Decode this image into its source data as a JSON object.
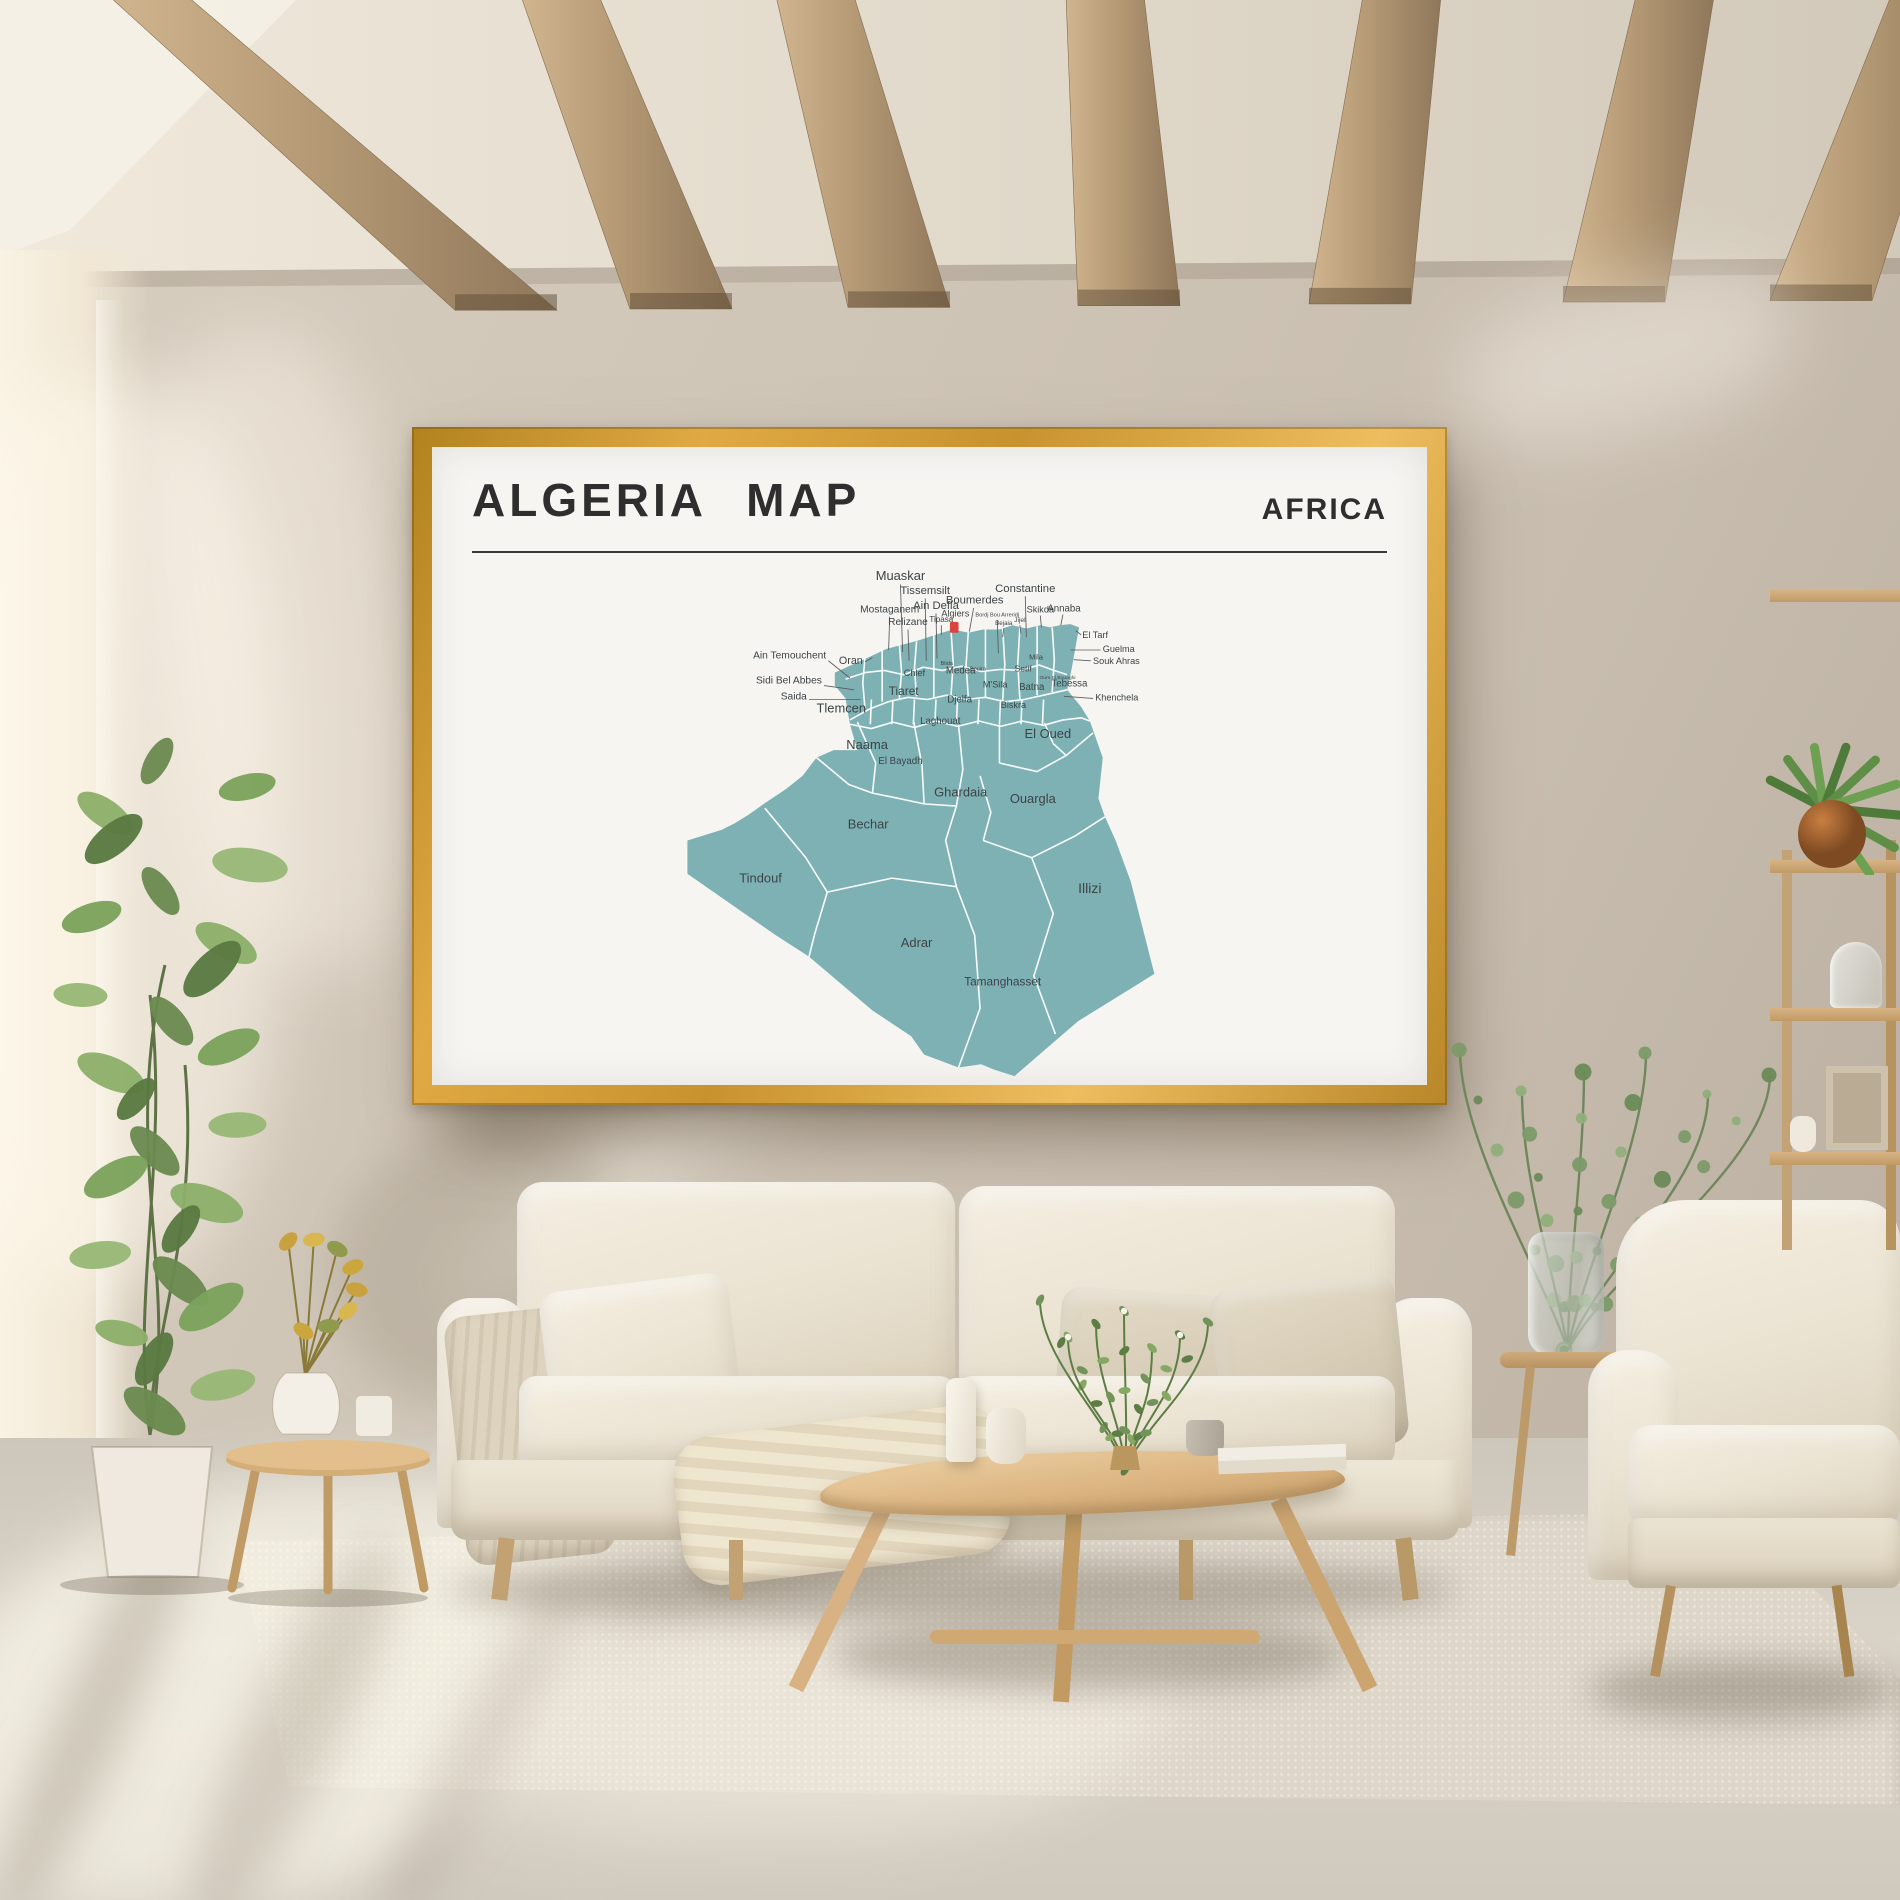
{
  "poster": {
    "title": "ALGERIA MAP",
    "region_label": "AFRICA",
    "frame_color": "#cf9a33",
    "paper_color": "#f6f5f2",
    "title_color": "#2e2e2e"
  },
  "map": {
    "country": "Algeria",
    "fill": "#7db1b4",
    "border_color": "#ffffff",
    "label_color": "#3d4446",
    "marker": {
      "label": "Algiers",
      "color": "#d9453e",
      "x": 424,
      "y": 59,
      "w": 8,
      "h": 10
    },
    "labels": [
      {
        "t": "Muaskar",
        "x": 378,
        "y": 20,
        "fs": 12,
        "a": "m"
      },
      {
        "t": "Tissemsilt",
        "x": 401,
        "y": 33,
        "fs": 10.5,
        "a": "m"
      },
      {
        "t": "Ain Defla",
        "x": 411,
        "y": 47,
        "fs": 10.5,
        "a": "m"
      },
      {
        "t": "Boumerdes",
        "x": 447,
        "y": 42,
        "fs": 10.5,
        "a": "m"
      },
      {
        "t": "Constantine",
        "x": 494,
        "y": 31,
        "fs": 10.5,
        "a": "m"
      },
      {
        "t": "Mostaganem",
        "x": 368,
        "y": 50,
        "fs": 9.5,
        "a": "m"
      },
      {
        "t": "Relizane",
        "x": 385,
        "y": 62,
        "fs": 9.5,
        "a": "m"
      },
      {
        "t": "Tipasa",
        "x": 416,
        "y": 59,
        "fs": 7.5,
        "a": "m"
      },
      {
        "t": "Algiers",
        "x": 429,
        "y": 54,
        "fs": 8.5,
        "a": "m"
      },
      {
        "t": "Bordj Bou Arreridj",
        "x": 468,
        "y": 54,
        "fs": 5.2,
        "a": "m"
      },
      {
        "t": "Bejaia",
        "x": 474,
        "y": 62,
        "fs": 5.8,
        "a": "m"
      },
      {
        "t": "Jijel",
        "x": 489,
        "y": 59,
        "fs": 6.2,
        "a": "m"
      },
      {
        "t": "Skikda",
        "x": 508,
        "y": 50,
        "fs": 8.5,
        "a": "m"
      },
      {
        "t": "Annaba",
        "x": 530,
        "y": 49,
        "fs": 9,
        "a": "m"
      },
      {
        "t": "El Tarf",
        "x": 547,
        "y": 74,
        "fs": 8.5,
        "a": "s"
      },
      {
        "t": "Guelma",
        "x": 566,
        "y": 87,
        "fs": 8.5,
        "a": "s"
      },
      {
        "t": "Souk Ahras",
        "x": 557,
        "y": 98,
        "fs": 8.5,
        "a": "s"
      },
      {
        "t": "Ain Temouchent",
        "x": 309,
        "y": 93,
        "fs": 9.5,
        "a": "e"
      },
      {
        "t": "Oran",
        "x": 343,
        "y": 98,
        "fs": 10,
        "a": "e"
      },
      {
        "t": "Sidi Bel Abbes",
        "x": 305,
        "y": 116,
        "fs": 9.5,
        "a": "e"
      },
      {
        "t": "Saida",
        "x": 291,
        "y": 131,
        "fs": 9.5,
        "a": "e"
      },
      {
        "t": "Khenchela",
        "x": 559,
        "y": 132,
        "fs": 8.5,
        "a": "s"
      },
      {
        "t": "Tlemcen",
        "x": 323,
        "y": 143,
        "fs": 12,
        "a": "m"
      },
      {
        "t": "Chlef",
        "x": 391,
        "y": 109,
        "fs": 8.5,
        "a": "m"
      },
      {
        "t": "Medea",
        "x": 434,
        "y": 107,
        "fs": 9,
        "a": "m"
      },
      {
        "t": "Blida",
        "x": 421,
        "y": 99,
        "fs": 5.2,
        "a": "m"
      },
      {
        "t": "Bouira",
        "x": 450,
        "y": 104,
        "fs": 5.2,
        "a": "m"
      },
      {
        "t": "Mila",
        "x": 504,
        "y": 94,
        "fs": 7,
        "a": "m"
      },
      {
        "t": "Setif",
        "x": 492,
        "y": 105,
        "fs": 8,
        "a": "m"
      },
      {
        "t": "Oum El Bouaghi",
        "x": 524,
        "y": 112,
        "fs": 4.6,
        "a": "m"
      },
      {
        "t": "M'Sila",
        "x": 466,
        "y": 120,
        "fs": 8.5,
        "a": "m"
      },
      {
        "t": "Batna",
        "x": 500,
        "y": 122,
        "fs": 9,
        "a": "m"
      },
      {
        "t": "Biskra",
        "x": 483,
        "y": 139,
        "fs": 8.5,
        "a": "m"
      },
      {
        "t": "Tebessa",
        "x": 535,
        "y": 119,
        "fs": 9,
        "a": "m"
      },
      {
        "t": "Tiaret",
        "x": 381,
        "y": 127,
        "fs": 11,
        "a": "m"
      },
      {
        "t": "Djelfa",
        "x": 433,
        "y": 134,
        "fs": 9,
        "a": "m"
      },
      {
        "t": "Laghouat",
        "x": 415,
        "y": 154,
        "fs": 9,
        "a": "m"
      },
      {
        "t": "Naama",
        "x": 347,
        "y": 177,
        "fs": 12,
        "a": "m"
      },
      {
        "t": "El Bayadh",
        "x": 378,
        "y": 191,
        "fs": 9,
        "a": "m"
      },
      {
        "t": "El Oued",
        "x": 515,
        "y": 167,
        "fs": 12,
        "a": "m"
      },
      {
        "t": "Ghardaia",
        "x": 434,
        "y": 221,
        "fs": 12,
        "a": "m"
      },
      {
        "t": "Ouargla",
        "x": 501,
        "y": 227,
        "fs": 12,
        "a": "m"
      },
      {
        "t": "Bechar",
        "x": 348,
        "y": 251,
        "fs": 12,
        "a": "m"
      },
      {
        "t": "Tindouf",
        "x": 248,
        "y": 301,
        "fs": 12,
        "a": "m"
      },
      {
        "t": "Adrar",
        "x": 393,
        "y": 361,
        "fs": 12,
        "a": "m"
      },
      {
        "t": "Illizi",
        "x": 554,
        "y": 311,
        "fs": 13,
        "a": "m"
      },
      {
        "t": "Tamanghasset",
        "x": 473,
        "y": 397,
        "fs": 11,
        "a": "m"
      }
    ],
    "leaders": [
      [
        378,
        24,
        380,
        87
      ],
      [
        401,
        37,
        402,
        95
      ],
      [
        411,
        51,
        412,
        93
      ],
      [
        446,
        46,
        442,
        68
      ],
      [
        494,
        35,
        495,
        73
      ],
      [
        368,
        54,
        367,
        85
      ],
      [
        385,
        66,
        386,
        95
      ],
      [
        416,
        62,
        416,
        71
      ],
      [
        468,
        57,
        469,
        88
      ],
      [
        474,
        65,
        473,
        73
      ],
      [
        489,
        62,
        490,
        70
      ],
      [
        508,
        53,
        509,
        64
      ],
      [
        529,
        52,
        527,
        62
      ],
      [
        546,
        71,
        541,
        67
      ],
      [
        564,
        85,
        536,
        85
      ],
      [
        555,
        95,
        539,
        94
      ],
      [
        311,
        95,
        331,
        111
      ],
      [
        345,
        96,
        352,
        92
      ],
      [
        307,
        118,
        335,
        122
      ],
      [
        293,
        131,
        341,
        131
      ],
      [
        557,
        130,
        530,
        128
      ]
    ]
  }
}
